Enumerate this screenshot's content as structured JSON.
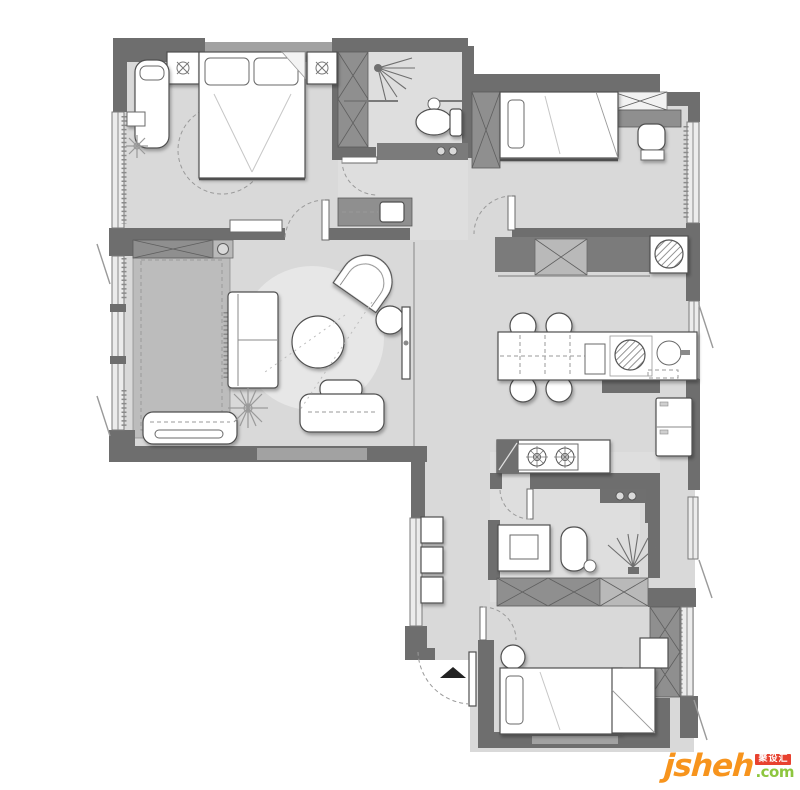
{
  "meta": {
    "type": "residential-floor-plan",
    "canvas_width": 800,
    "canvas_height": 790
  },
  "palette": {
    "background": "#ffffff",
    "floor": "#d9d9d9",
    "floor_bath": "#dedede",
    "wall": "#6e6e6e",
    "wall_light": "#a2a2a2",
    "cabinet": "#8f8f8f",
    "cabinet_light": "#b9b9b9",
    "panel": "#bcbcbc",
    "rug": "#e7e7e7",
    "furniture_fill": "#ffffff",
    "furniture_stroke": "#4f4f4f"
  },
  "watermark": {
    "brand": "jsheh",
    "tld": ".com",
    "badge": "聚设汇",
    "brand_color": "#f7941d",
    "tld_color": "#8dc63f",
    "badge_bg": "#e8412f",
    "badge_text_color": "#ffffff"
  },
  "rooms": [
    {
      "name": "master-bedroom",
      "furniture": [
        "double-bed",
        "pillows",
        "nightstand-left",
        "nightstand-right",
        "daybed",
        "side-table",
        "plant",
        "dashed-rug"
      ]
    },
    {
      "name": "bathroom-main",
      "furniture": [
        "shower",
        "toilet",
        "counter-with-knobs",
        "wardrobe"
      ]
    },
    {
      "name": "corridor",
      "furniture": [
        "vanity-basin-cabinet"
      ]
    },
    {
      "name": "bedroom-2",
      "furniture": [
        "single-bed",
        "pillow",
        "wardrobe",
        "closet",
        "desk-counter",
        "chair"
      ]
    },
    {
      "name": "living-room",
      "furniture": [
        "sofa",
        "coffee-table",
        "round-rug",
        "armchair",
        "ottoman",
        "tv",
        "window-bench",
        "media-bench",
        "plant",
        "tatami-panel",
        "storage-cabinet"
      ]
    },
    {
      "name": "dining-kitchen",
      "furniture": [
        "dining-island",
        "chairs-x4",
        "induction-cooktop",
        "sink",
        "washing-machine",
        "tall-cabinet",
        "fridge",
        "gas-stove",
        "counter"
      ]
    },
    {
      "name": "hallway",
      "furniture": [
        "shoe-cabinets-x3",
        "entry-door",
        "entry-arrow"
      ]
    },
    {
      "name": "bathroom-2",
      "furniture": [
        "vanity",
        "toilet",
        "shower",
        "shelf-with-knobs"
      ]
    },
    {
      "name": "bedroom-3",
      "furniture": [
        "bed",
        "pillow",
        "round-side-table",
        "wardrobe-row",
        "closet-column",
        "nightstand"
      ]
    }
  ]
}
